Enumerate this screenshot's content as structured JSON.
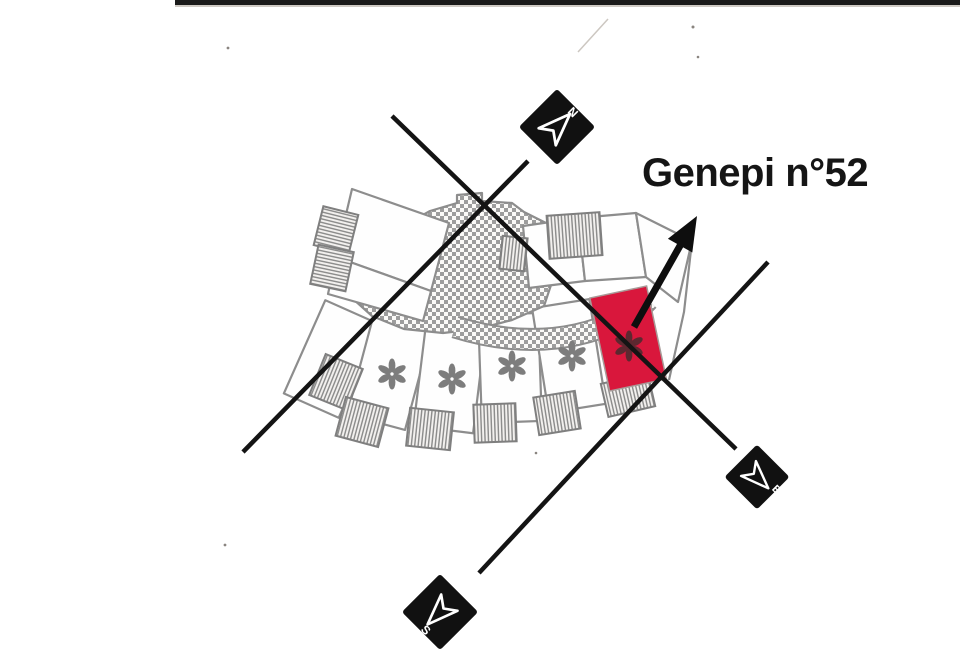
{
  "unit_label": {
    "text": "Genepi n°52"
  },
  "compass": {
    "north_letter": "N",
    "east_letter": "E",
    "south_letter": "S"
  },
  "colors": {
    "highlight_red": "#d9173c",
    "marker_black": "#111111",
    "marker_white": "#ffffff",
    "plan_gray": "#8d8d8d",
    "annotation_black": "#0e0e0e"
  },
  "plan": {
    "white_asterisk_units": 4,
    "highlighted_asterisk_units": 1
  }
}
